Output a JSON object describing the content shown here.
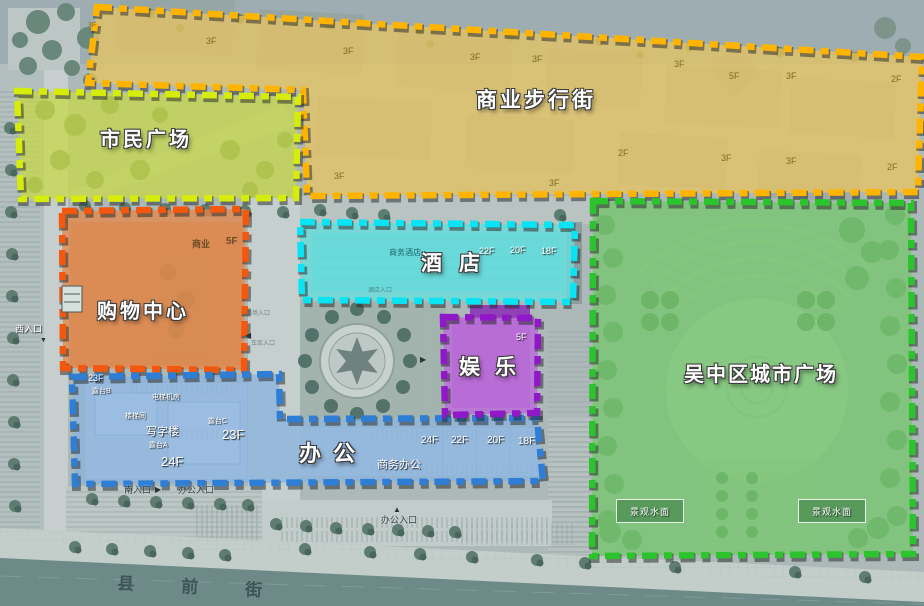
{
  "map": {
    "background_color": "#ACB9B8",
    "street_color": "#6E8A88",
    "zones": [
      {
        "id": "commercial-street",
        "label": "商业步行街",
        "points": "97,7 922,57 918,192 307,196 303,90 88,83",
        "fill": "rgba(230,196,100,0.78)",
        "stroke": "#FFB400",
        "lx": 476,
        "ly": 90,
        "fs": 21,
        "ls": 3
      },
      {
        "id": "citizens-plaza",
        "label": "市民广场",
        "points": "17,91 298,97 296,198 21,199",
        "fill": "rgba(198,216,72,0.74)",
        "stroke": "#D6EC0A",
        "lx": 100,
        "ly": 130,
        "fs": 20,
        "ls": 3
      },
      {
        "id": "city-plaza",
        "label": "吴中区城市广场",
        "points": "593,201 911,203 913,554 592,556",
        "fill": "rgba(118,199,110,0.75)",
        "stroke": "#2CC42C",
        "lx": 684,
        "ly": 365,
        "fs": 20,
        "ls": 2
      },
      {
        "id": "hotel",
        "label": "酒店",
        "points": "300,222 575,225 573,302 302,300",
        "fill": "rgba(105,222,222,0.8)",
        "stroke": "#08E4F4",
        "lx": 421,
        "ly": 253,
        "fs": 21,
        "ls": 17
      },
      {
        "id": "shopping-center",
        "label": "购物中心",
        "points": "62,211 246,209 244,370 63,368",
        "fill": "rgba(226,138,77,0.8)",
        "stroke": "#F4570E",
        "lx": 97,
        "ly": 302,
        "fs": 20,
        "ls": 3
      },
      {
        "id": "office",
        "label": "办公",
        "points": "72,377 279,374 280,419 537,418 543,481 75,484",
        "fill": "rgba(140,180,222,0.78)",
        "stroke": "#2E7ED6",
        "lx": 299,
        "ly": 443,
        "fs": 22,
        "ls": 12
      },
      {
        "id": "entertainment",
        "label": "娱乐",
        "points": "443,317 538,318 537,413 445,415",
        "fill": "rgba(188,105,220,0.8)",
        "stroke": "#9018C8",
        "lx": 459,
        "ly": 357,
        "fs": 21,
        "ls": 15
      }
    ],
    "floor_labels": [
      {
        "t": "3F",
        "x": 206,
        "y": 37,
        "c": "olv",
        "s": 9
      },
      {
        "t": "3F",
        "x": 343,
        "y": 47,
        "c": "olv",
        "s": 9
      },
      {
        "t": "3F",
        "x": 470,
        "y": 53,
        "c": "olv",
        "s": 9
      },
      {
        "t": "3F",
        "x": 532,
        "y": 55,
        "c": "olv",
        "s": 9
      },
      {
        "t": "3F",
        "x": 674,
        "y": 60,
        "c": "olv",
        "s": 9
      },
      {
        "t": "5F",
        "x": 729,
        "y": 72,
        "c": "olv",
        "s": 9
      },
      {
        "t": "3F",
        "x": 786,
        "y": 72,
        "c": "olv",
        "s": 9
      },
      {
        "t": "2F",
        "x": 891,
        "y": 75,
        "c": "olv",
        "s": 9
      },
      {
        "t": "3F",
        "x": 334,
        "y": 172,
        "c": "olv",
        "s": 9
      },
      {
        "t": "2F",
        "x": 618,
        "y": 149,
        "c": "olv",
        "s": 9
      },
      {
        "t": "3F",
        "x": 721,
        "y": 154,
        "c": "olv",
        "s": 9
      },
      {
        "t": "3F",
        "x": 786,
        "y": 157,
        "c": "olv",
        "s": 9
      },
      {
        "t": "2F",
        "x": 887,
        "y": 163,
        "c": "olv",
        "s": 9
      },
      {
        "t": "3F",
        "x": 549,
        "y": 179,
        "c": "olv",
        "s": 9
      },
      {
        "t": "3F",
        "x": 88,
        "y": 22,
        "c": "olv",
        "s": 7
      },
      {
        "t": "商业",
        "x": 192,
        "y": 240,
        "c": "dko",
        "s": 9
      },
      {
        "t": "5F",
        "x": 226,
        "y": 237,
        "c": "dko",
        "s": 10
      },
      {
        "t": "商务酒店",
        "x": 389,
        "y": 249,
        "c": "dkt",
        "s": 8
      },
      {
        "t": "22F",
        "x": 479,
        "y": 247,
        "c": "wt",
        "s": 9
      },
      {
        "t": "20F",
        "x": 510,
        "y": 246,
        "c": "wt",
        "s": 9
      },
      {
        "t": "18F",
        "x": 541,
        "y": 247,
        "c": "wt",
        "s": 9
      },
      {
        "t": "5F",
        "x": 516,
        "y": 333,
        "c": "wt",
        "s": 9
      },
      {
        "t": "23F",
        "x": 88,
        "y": 374,
        "c": "wt",
        "s": 9
      },
      {
        "t": "露台B",
        "x": 92,
        "y": 388,
        "c": "wt",
        "s": 7
      },
      {
        "t": "电梯机房",
        "x": 152,
        "y": 394,
        "c": "wt",
        "s": 7
      },
      {
        "t": "楼梯间",
        "x": 125,
        "y": 413,
        "c": "wt",
        "s": 7
      },
      {
        "t": "露台C",
        "x": 208,
        "y": 418,
        "c": "wt",
        "s": 7
      },
      {
        "t": "写字楼",
        "x": 146,
        "y": 427,
        "c": "wt",
        "s": 11
      },
      {
        "t": "露台A",
        "x": 149,
        "y": 442,
        "c": "wt",
        "s": 7
      },
      {
        "t": "23F",
        "x": 222,
        "y": 428,
        "c": "wt",
        "s": 13
      },
      {
        "t": "24F",
        "x": 161,
        "y": 455,
        "c": "wt",
        "s": 13
      },
      {
        "t": "24F",
        "x": 421,
        "y": 436,
        "c": "wt",
        "s": 10
      },
      {
        "t": "22F",
        "x": 451,
        "y": 436,
        "c": "wt",
        "s": 10
      },
      {
        "t": "20F",
        "x": 487,
        "y": 436,
        "c": "wt",
        "s": 10
      },
      {
        "t": "18F",
        "x": 518,
        "y": 437,
        "c": "wt",
        "s": 10
      },
      {
        "t": "商务办公",
        "x": 377,
        "y": 460,
        "c": "wt",
        "s": 11
      }
    ],
    "entrance_labels": [
      {
        "t": "西入口",
        "x": 15,
        "y": 325,
        "c": "wt",
        "s": 9
      },
      {
        "t": "南入口",
        "x": 124,
        "y": 486,
        "c": "dke",
        "s": 9
      },
      {
        "t": "办公入口",
        "x": 178,
        "y": 486,
        "c": "dke",
        "s": 9
      },
      {
        "t": "办公入口",
        "x": 381,
        "y": 516,
        "c": "dke",
        "s": 9
      },
      {
        "t": "商场入口",
        "x": 246,
        "y": 311,
        "c": "fnt",
        "s": 6
      },
      {
        "t": "车库入口",
        "x": 251,
        "y": 341,
        "c": "fnt",
        "s": 6
      },
      {
        "t": "酒店入口",
        "x": 368,
        "y": 288,
        "c": "fnt",
        "s": 6
      }
    ],
    "arrows": [
      {
        "t": "▼",
        "x": 40,
        "y": 337,
        "s": 7
      },
      {
        "t": "◀",
        "x": 245,
        "y": 332,
        "s": 8
      },
      {
        "t": "▶",
        "x": 155,
        "y": 486,
        "s": 8
      },
      {
        "t": "▲",
        "x": 393,
        "y": 506,
        "s": 8
      },
      {
        "t": "▶",
        "x": 420,
        "y": 356,
        "s": 8
      }
    ],
    "water_features": [
      {
        "label": "景观水面",
        "x": 616,
        "y": 499,
        "w": 66,
        "h": 22
      },
      {
        "label": "景观水面",
        "x": 798,
        "y": 499,
        "w": 66,
        "h": 22
      }
    ],
    "street": {
      "label": "县前街"
    }
  }
}
